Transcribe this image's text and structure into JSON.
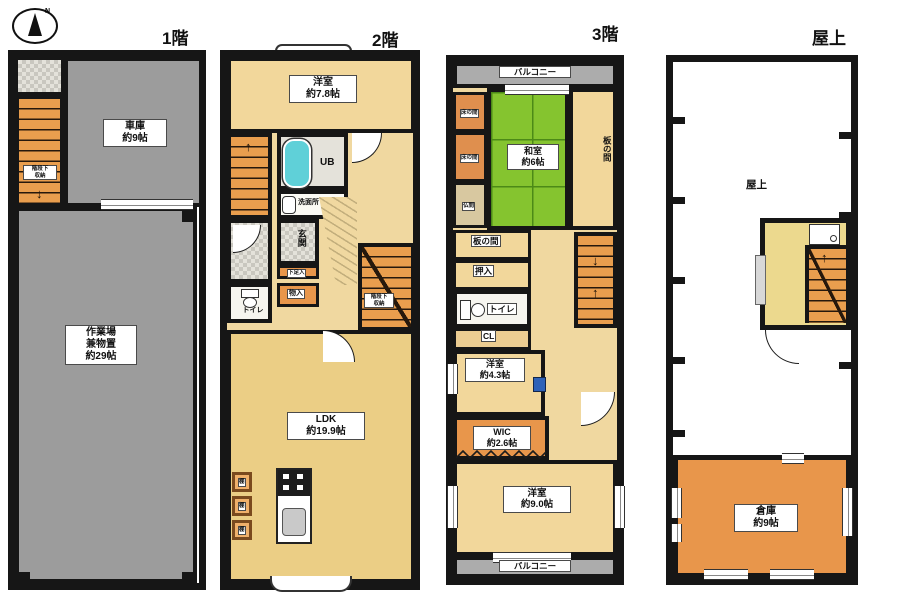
{
  "compass": {
    "north": "N"
  },
  "icons": {
    "arrow_up": "↑",
    "arrow_down": "↓"
  },
  "floors": {
    "f1": {
      "title": "1階",
      "garage": "車庫\n約9帖",
      "workshop": "作業場\n兼物置\n約29帖",
      "understair": "階段下\n収納"
    },
    "f2": {
      "title": "2階",
      "bedroom": "洋室\n約7.8帖",
      "ub": "UB",
      "washroom": "洗面所",
      "genkan": "玄関",
      "shoe": "下足入",
      "closet": "物入",
      "toilet": "トイレ",
      "understair": "階段下\n収納",
      "shelf": "棚",
      "ldk": "LDK\n約19.9帖"
    },
    "f3": {
      "title": "3階",
      "balcony_top": "バルコニー",
      "tokonoma": "床の間",
      "washitsu": "和室\n約6帖",
      "itanoma_side": "板の間",
      "butsuma": "仏間",
      "itanoma": "板の間",
      "oshiire": "押入",
      "toilet": "トイレ",
      "cl": "CL",
      "bedroom43": "洋室\n約4.3帖",
      "wic": "WIC\n約2.6帖",
      "bedroom90": "洋室\n約9.0帖",
      "balcony_bottom": "バルコニー"
    },
    "roof": {
      "title": "屋上",
      "terrace": "屋上",
      "storage": "倉庫\n約9帖"
    }
  },
  "colors": {
    "wall": "#161616",
    "garage_gray": "#9c9c9c",
    "room_tan": "#f2d79b",
    "ldk_tan": "#ebce85",
    "stair_orange": "#e99e4e",
    "closet_orange": "#e8964b",
    "tatami_green": "#85c42f",
    "balcony_gray": "#acacac",
    "tile_gray": "#e4e2da",
    "tub_teal": "#5fd0d8"
  }
}
